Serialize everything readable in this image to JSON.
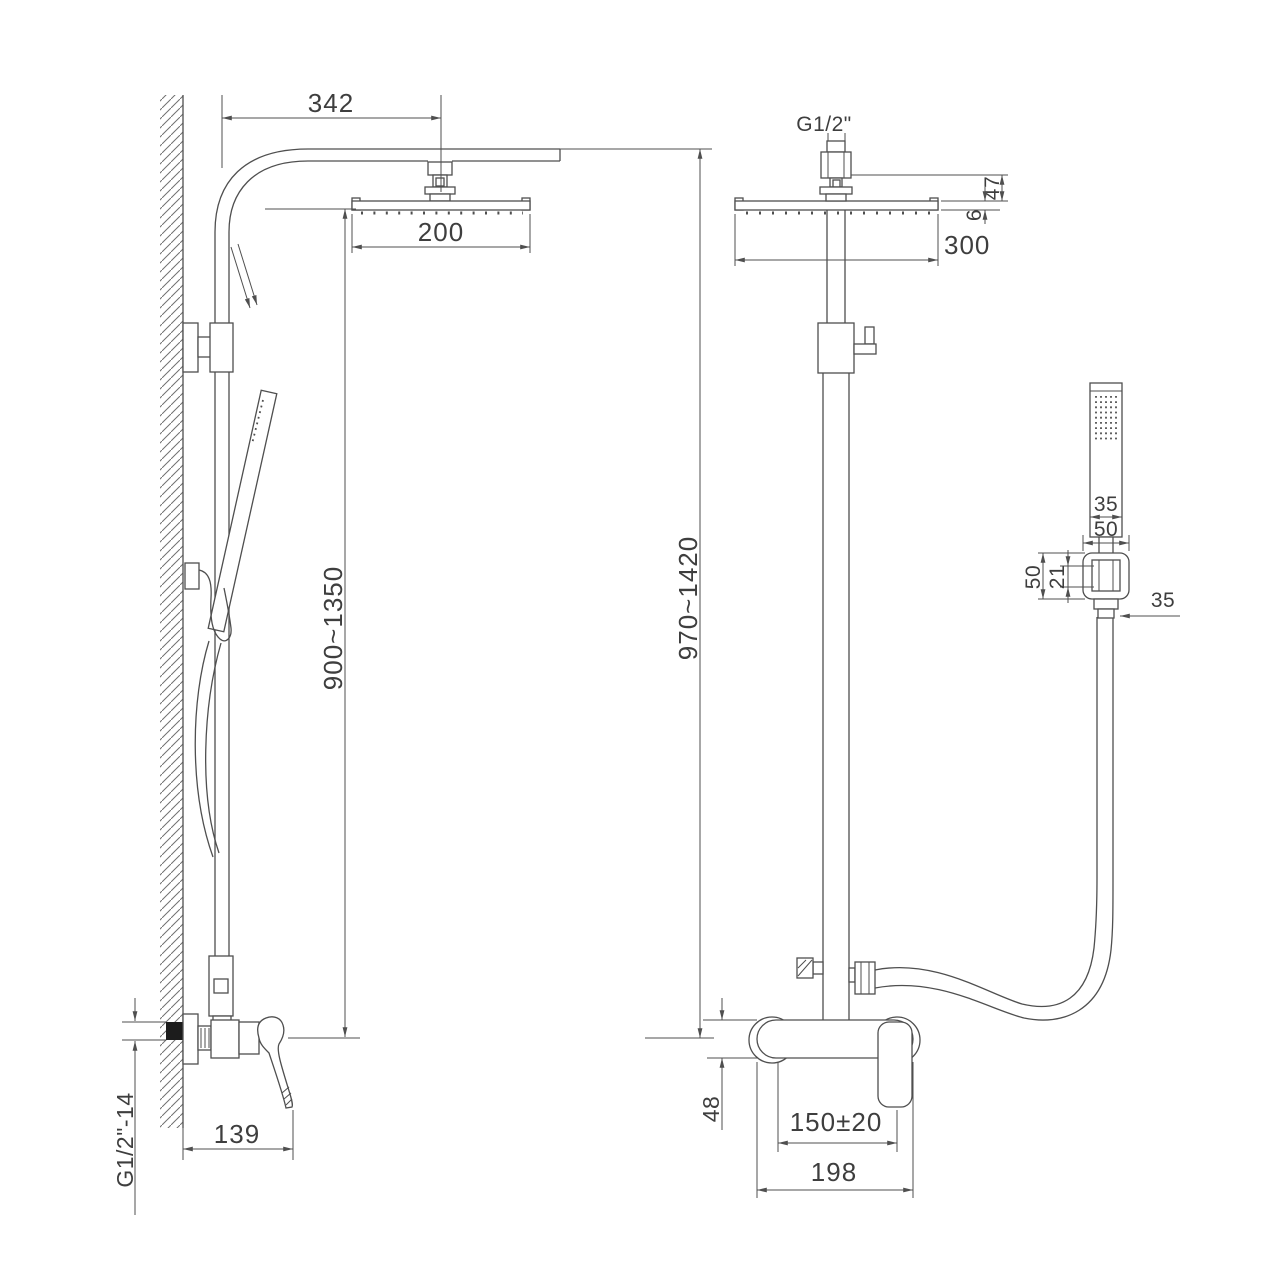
{
  "page": {
    "background": "#ffffff"
  },
  "drawing": {
    "colors": {
      "line": "#4f4f4f",
      "text": "#3e3e3e",
      "seal": "#1c1c1c",
      "background": "#ffffff"
    },
    "dims": {
      "arm_offset": "342",
      "head_width_side": "200",
      "top_thread": "G1/2\"",
      "head_width_front": "300",
      "head_connector_height": "47",
      "head_thickness": "6",
      "height_side": "900~1350",
      "height_front": "970~1420",
      "hand_shower_width": "35",
      "holder_width": "50",
      "holder_height": "50",
      "holder_nut_height": "21",
      "holder_connector_width": "35",
      "bottom_thread": "G1/2\"-14",
      "wall_to_handle_tip": "139",
      "mixer_body_height": "48",
      "inlet_spacing": "150±20",
      "mixer_body_width": "198"
    }
  }
}
